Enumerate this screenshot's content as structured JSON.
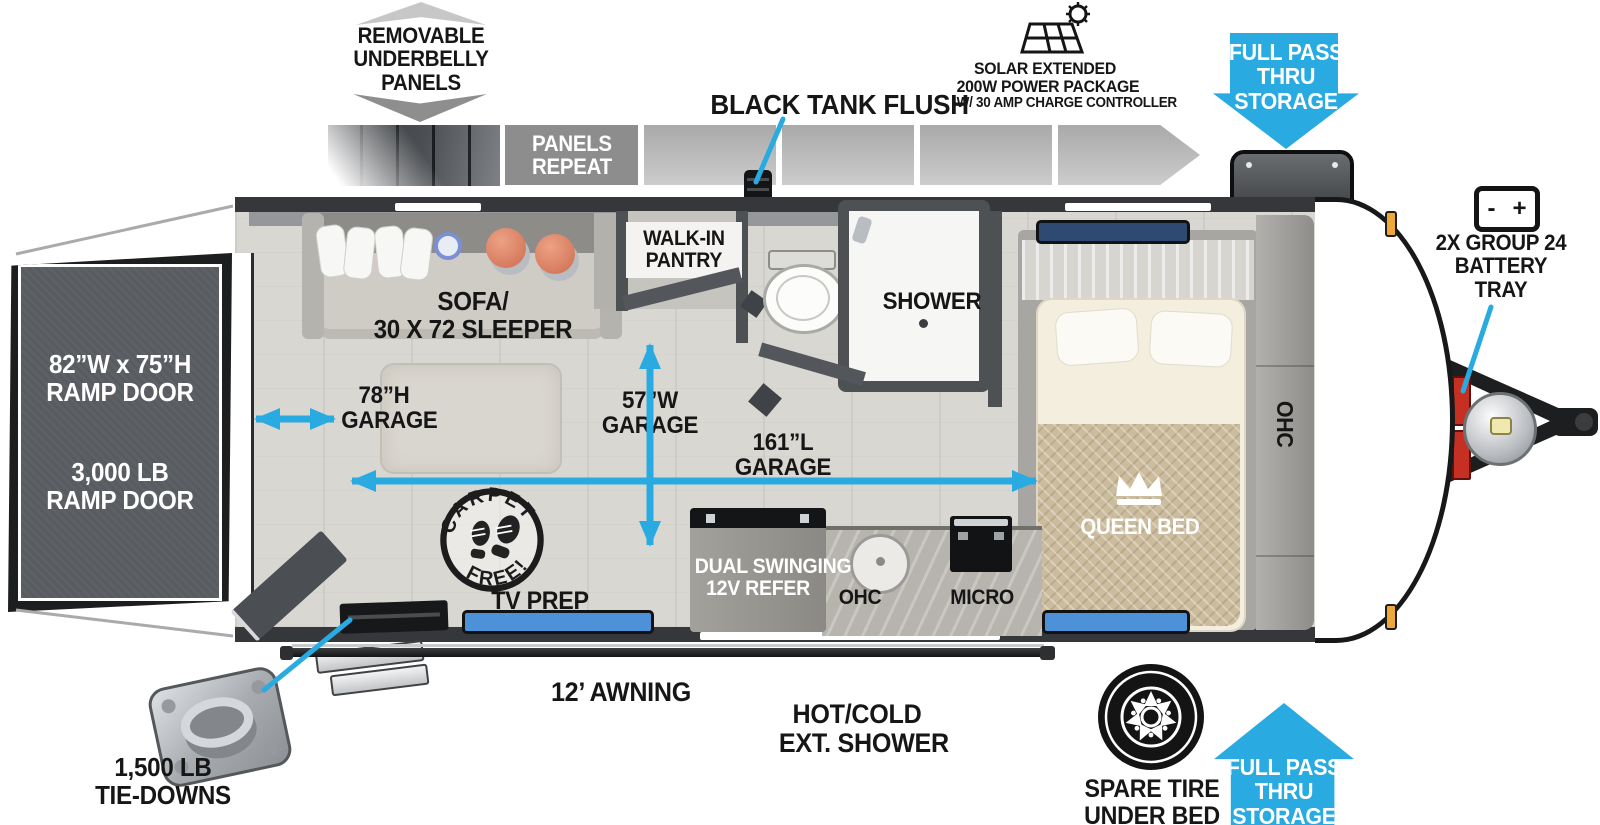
{
  "colors": {
    "accent": "#29abe2",
    "wall": "#35373a",
    "ramp": "#585c60"
  },
  "callouts": {
    "underbelly": {
      "l1": "REMOVABLE",
      "l2": "UNDERBELLY",
      "l3": "PANELS"
    },
    "panels_repeat": {
      "l1": "PANELS",
      "l2": "REPEAT"
    },
    "black_tank_flush": {
      "label": "BLACK TANK FLUSH"
    },
    "solar": {
      "l1": "SOLAR EXTENDED",
      "l2": "200W POWER PACKAGE",
      "l3": "W/ 30 AMP CHARGE CONTROLLER"
    },
    "pass_thru_front": {
      "l1": "FULL PASS",
      "l2": "THRU",
      "l3": "STORAGE"
    },
    "battery_tray": {
      "l1": "2X GROUP 24",
      "l2": "BATTERY",
      "l3": "TRAY"
    },
    "tie_downs": {
      "l1": "1,500 LB",
      "l2": "TIE-DOWNS"
    },
    "awning": {
      "label": "12’ AWNING"
    },
    "ext_shower": {
      "l1": "HOT/COLD",
      "l2": "EXT. SHOWER"
    },
    "spare_tire": {
      "l1": "SPARE TIRE",
      "l2": "UNDER BED"
    },
    "pass_thru_rear": {
      "l1": "FULL PASS",
      "l2": "THRU",
      "l3": "STORAGE"
    }
  },
  "ramp_door": {
    "size_l1": "82”W x 75”H",
    "size_l2": "RAMP DOOR",
    "cap_l1": "3,000 LB",
    "cap_l2": "RAMP DOOR"
  },
  "rooms": {
    "sofa": {
      "l1": "SOFA/",
      "l2": "30 X 72 SLEEPER"
    },
    "pantry": {
      "l1": "WALK-IN",
      "l2": "PANTRY"
    },
    "shower": {
      "label": "SHOWER"
    },
    "queen_bed": {
      "label": "QUEEN BED"
    },
    "ohc_bedroom": {
      "label": "OHC"
    },
    "carpet_free": {
      "arc_top": "CARPET",
      "arc_bottom": "FREE!"
    },
    "tv_prep": {
      "label": "TV PREP"
    },
    "refrigerator": {
      "l1": "DUAL SWINGING",
      "l2": "12V REFER"
    },
    "ohc_kitchen": {
      "label": "OHC"
    },
    "micro": {
      "label": "MICRO"
    }
  },
  "dimensions": {
    "garage_height": {
      "l1": "78”H",
      "l2": "GARAGE"
    },
    "garage_width": {
      "l1": "57”W",
      "l2": "GARAGE"
    },
    "garage_length": {
      "l1": "161”L",
      "l2": "GARAGE"
    }
  }
}
